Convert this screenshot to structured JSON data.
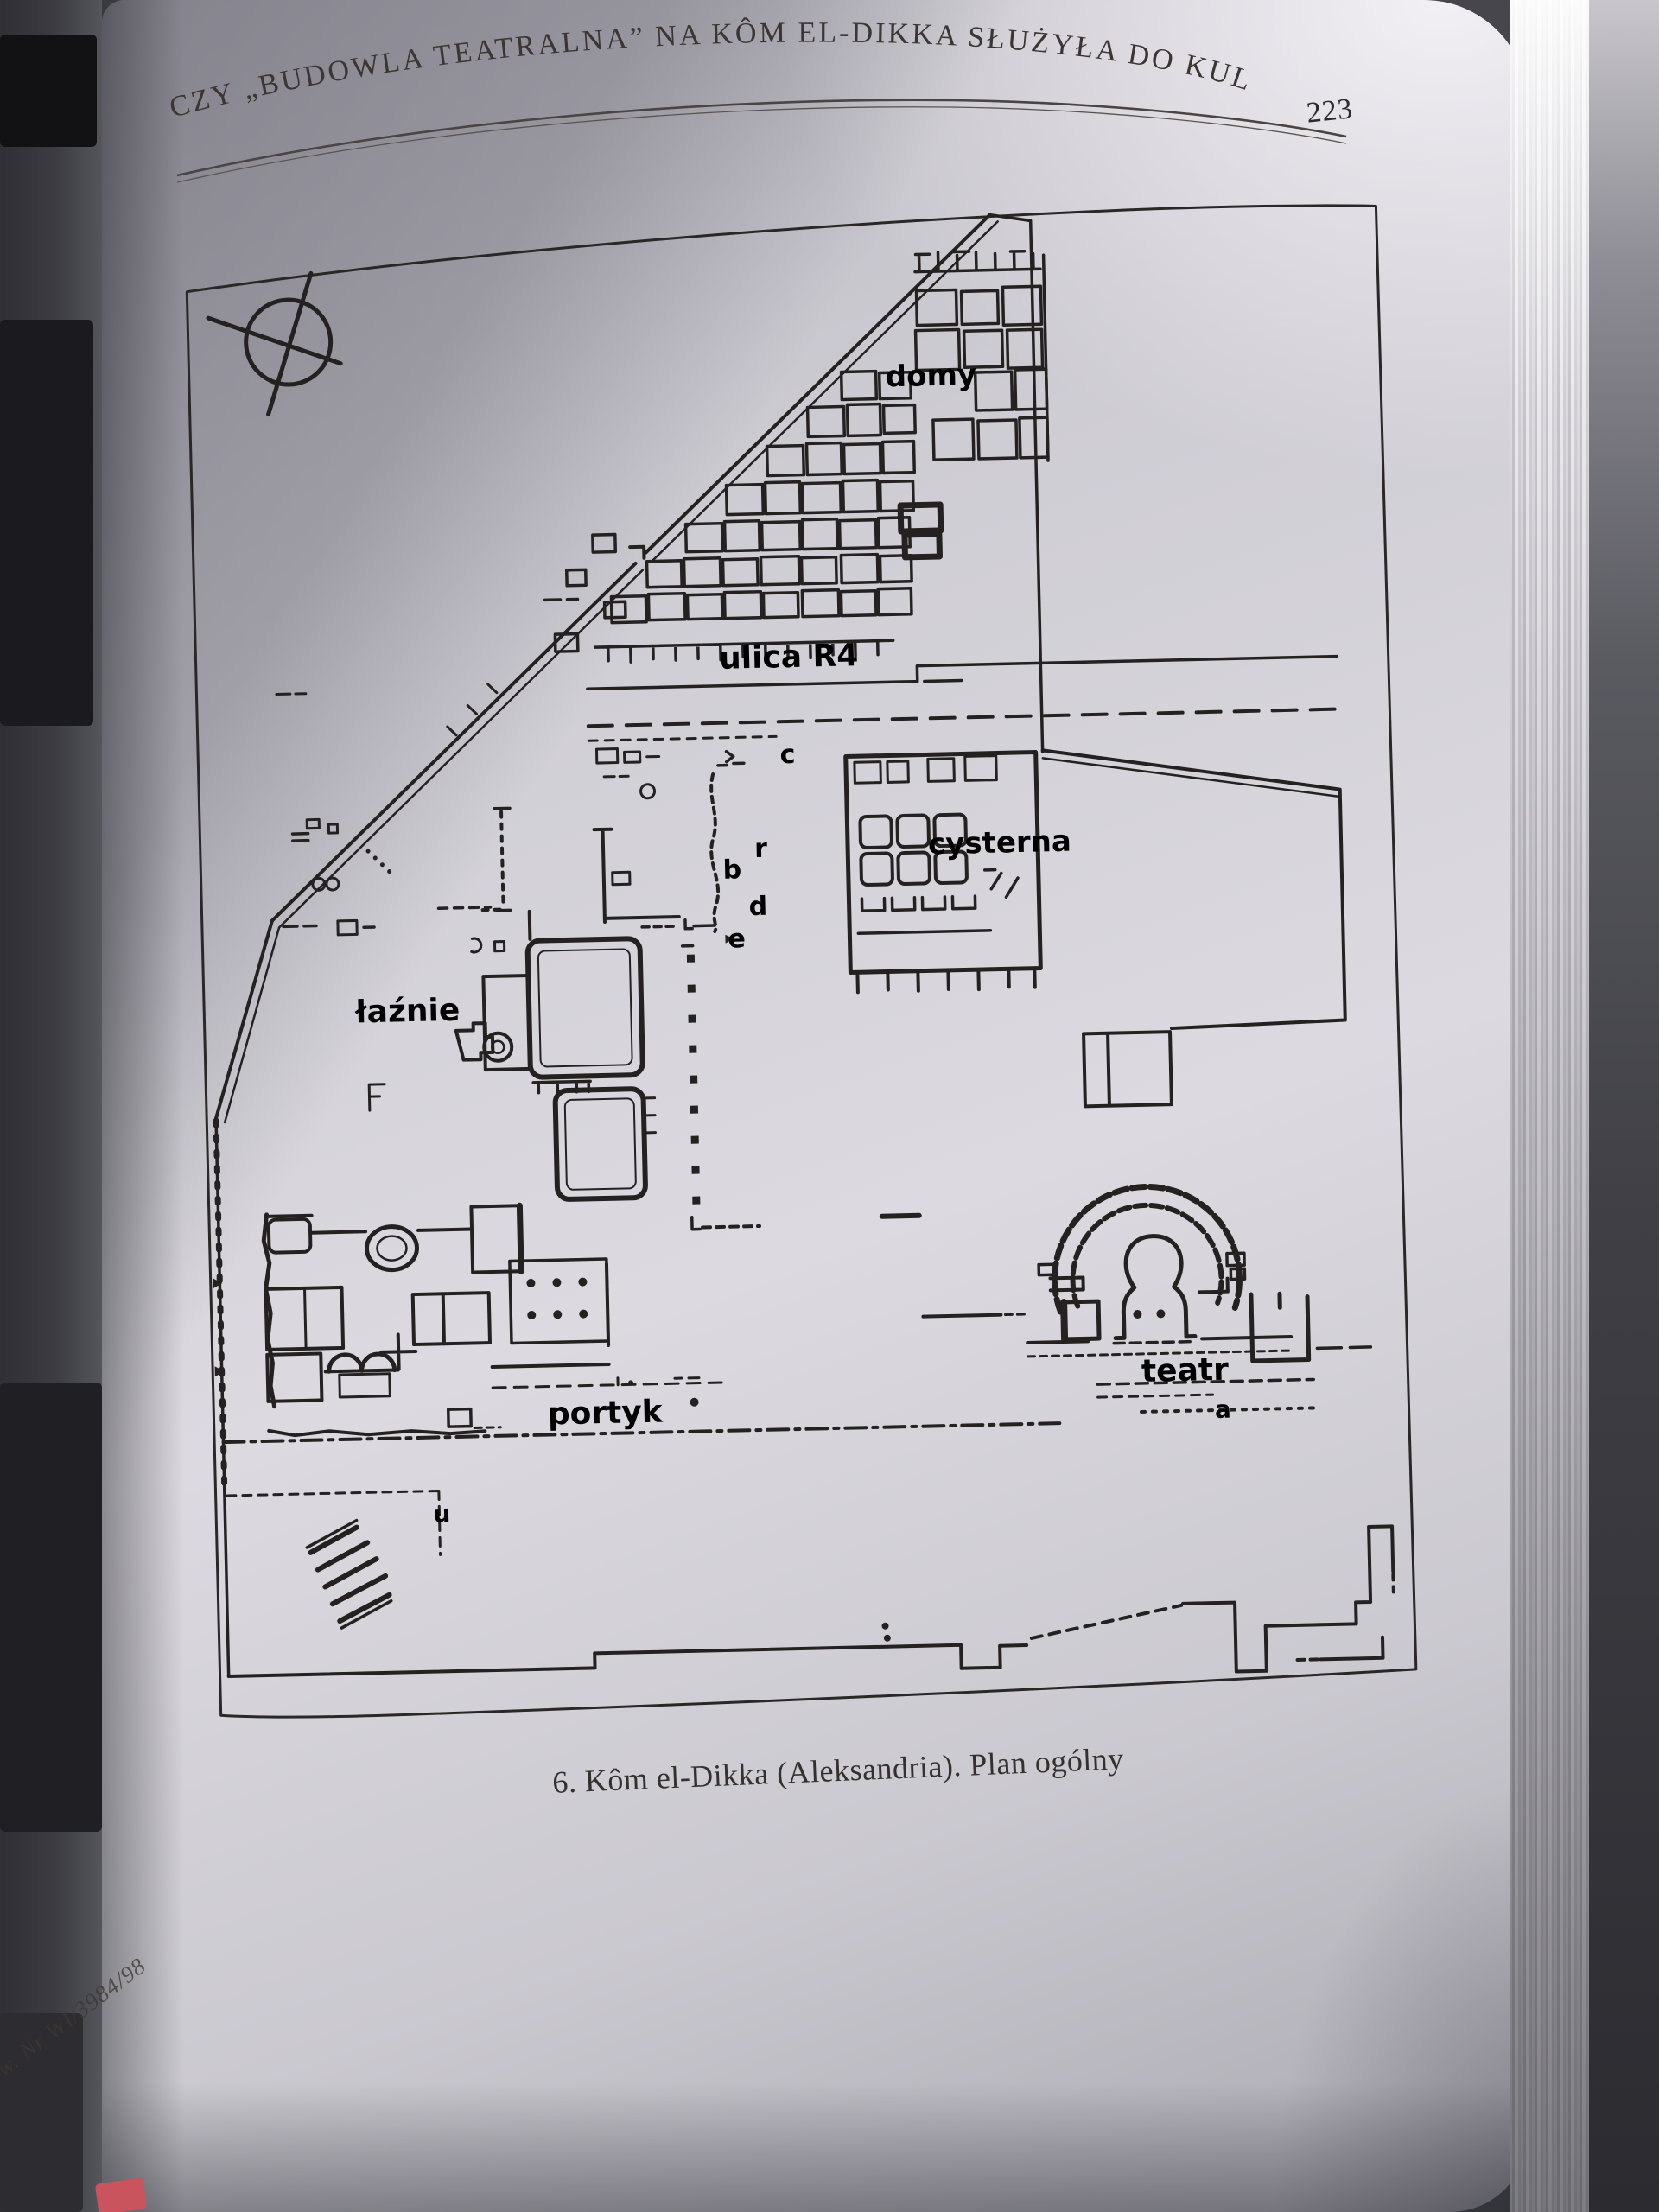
{
  "header": {
    "title": "CZY „BUDOWLA TEATRALNA” NA KÔM EL-DIKKA SŁUŻYŁA DO KULTU?",
    "page_number": "223"
  },
  "caption": "6. Kôm el-Dikka (Aleksandria). Plan ogólny",
  "spine_note": "w. Nr WI/3984/98",
  "plan": {
    "labels": {
      "domy": "domy",
      "ulica": "ulica R4",
      "cysterna": "cysterna",
      "laznie": "łaźnie",
      "portyk": "portyk",
      "teatr": "teatr"
    },
    "letters": {
      "c": "c",
      "r": "r",
      "b": "b",
      "d": "d",
      "e": "e",
      "a": "a",
      "u": "u"
    }
  },
  "colors": {
    "paper": "#d6d4da",
    "ink": "#242120",
    "bookmark": "#c9545e"
  }
}
